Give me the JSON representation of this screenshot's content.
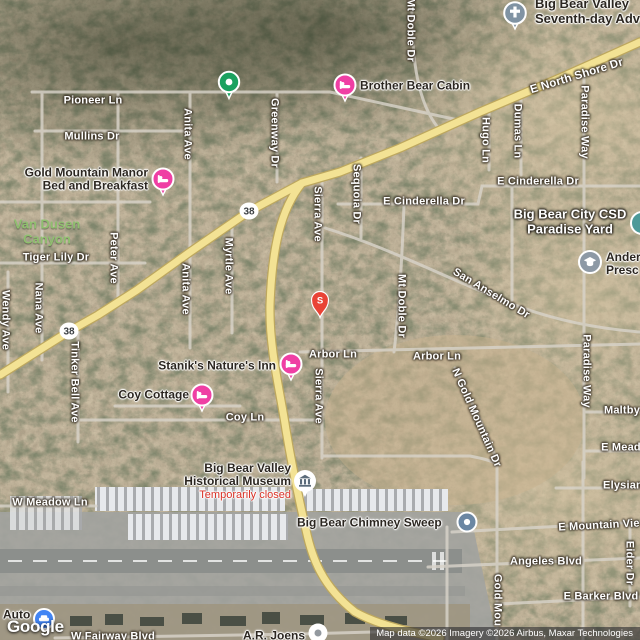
{
  "map": {
    "route_shield": "38",
    "s_pin_label": "S",
    "google_logo": "Google",
    "attribution": "Map data ©2026 Imagery ©2026 Airbus, Maxar Technologies",
    "streets": {
      "pioneer_ln": "Pioneer Ln",
      "mullins_dr": "Mullins Dr",
      "anita_ave": "Anita Ave",
      "greenway_dr": "Greenway Dr",
      "mt_doble_dr": "Mt Doble Dr",
      "e_north_shore_dr": "E North Shore Dr",
      "hugo_ln": "Hugo Ln",
      "dumas_ln": "Dumas Ln",
      "paradise_way": "Paradise Way",
      "e_cinderella_dr": "E Cinderella Dr",
      "sequoia_dr": "Sequoia Dr",
      "sierra_ave": "Sierra Ave",
      "myrtle_ave": "Myrtle Ave",
      "peter_ave": "Peter Ave",
      "nana_ave": "Nana Ave",
      "wendy_ave": "Wendy Ave",
      "tiger_lily_dr": "Tiger Lily Dr",
      "tinker_bell_ave": "Tinker Bell Ave",
      "san_anselmo_dr": "San Anselmo Dr",
      "arbor_ln": "Arbor Ln",
      "coy_ln": "Coy Ln",
      "maltby": "Maltby",
      "e_mead": "E Mead",
      "n_gold_mountain_dr": "N Gold Mountain Dr",
      "w_meadow_ln": "W Meadow Ln",
      "elysian": "Elysian",
      "e_mountain_vie": "E Mountain Vie",
      "angeles_blvd": "Angeles Blvd",
      "eider_dr": "Eider Dr",
      "gold_mou": "Gold Mou",
      "e_barker_blvd": "E Barker Blvd",
      "w_fairway_blvd": "W Fairway Blvd"
    },
    "pois": {
      "adventist_church": {
        "line1": "Big Bear Valley",
        "line2": "Seventh-day Adve"
      },
      "brother_bear_cabin": "Brother Bear Cabin",
      "gold_mountain_manor": {
        "line1": "Gold Mountain Manor",
        "line2": "Bed and Breakfast"
      },
      "van_dusen_canyon": {
        "line1": "Van Dusen",
        "line2": "Canyon"
      },
      "big_bear_city_csd": {
        "line1": "Big Bear City CSD",
        "line2": "Paradise Yard"
      },
      "anderson_preschool": {
        "line1": "Ander",
        "line2": "Presc"
      },
      "staniks_natures_inn": "Stanik's Nature's Inn",
      "coy_cottage": "Coy Cottage",
      "historical_museum": {
        "line1": "Big Bear Valley",
        "line2": "Historical Museum",
        "status": "Temporarily closed"
      },
      "big_bear_chimney_sweep": "Big Bear Chimney Sweep",
      "ar_joens": "A.R. Joens",
      "auto": "Auto"
    },
    "colors": {
      "road_major": "#f3e294",
      "road_major_casing": "#bda75e",
      "road_minor": "#d8d3c9",
      "lodging_pink": "#ef3fa4",
      "poi_green": "#1ba15f",
      "pin_red": "#e94335",
      "church_slate": "#8093a3",
      "school_gray": "#8d99a5",
      "museum_icon": "#5b6b7a",
      "dot_slate": "#6b87a3",
      "auto_blue": "#4285f4",
      "teal_partial": "#4d9a99",
      "joens_gray": "#93999f",
      "park_text_green": "#8fbf6e",
      "closed_red": "#d93025"
    }
  }
}
